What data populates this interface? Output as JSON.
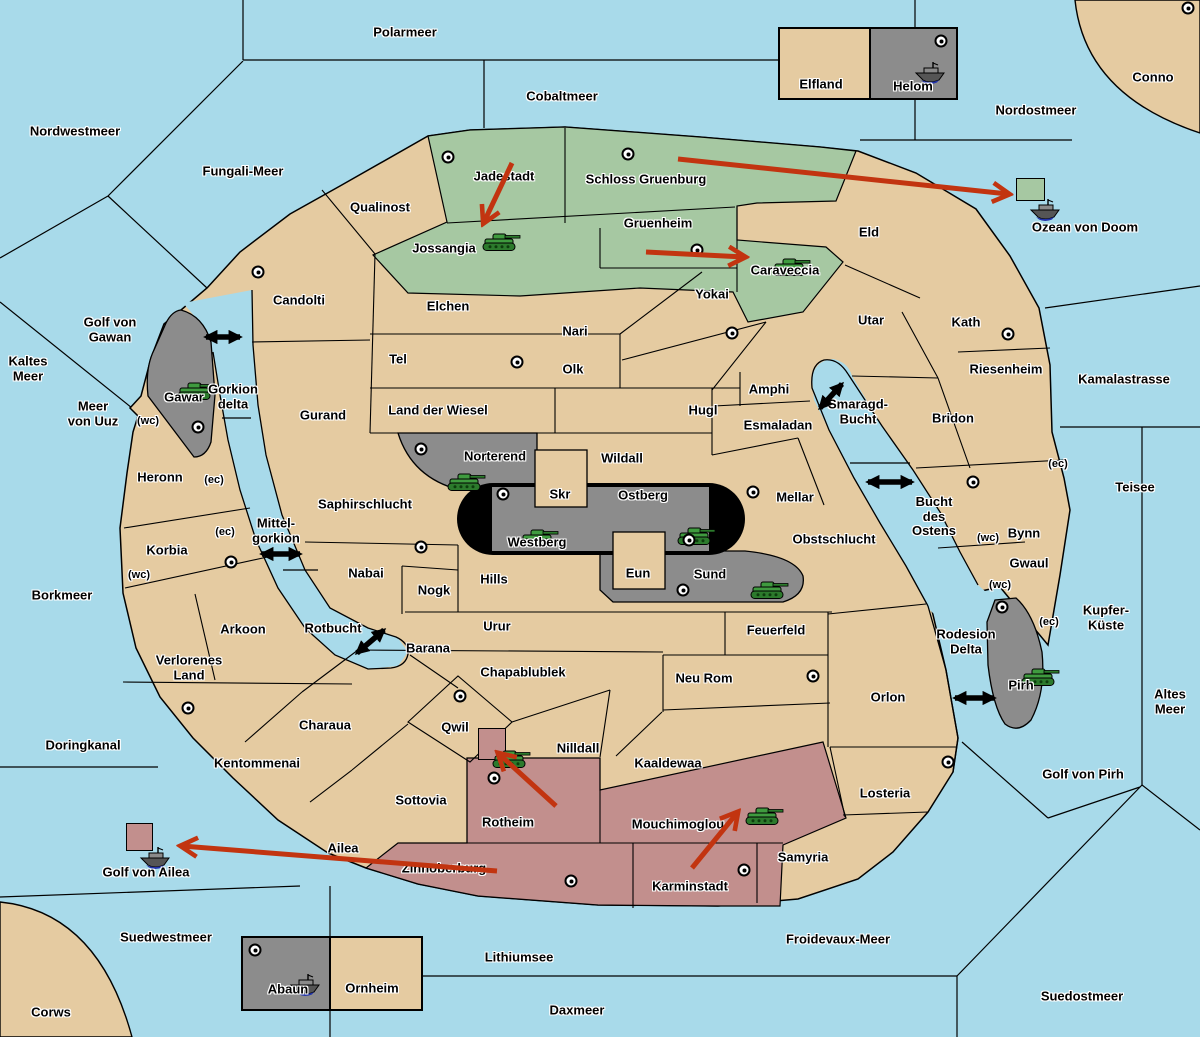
{
  "map": {
    "colors": {
      "water": "#a8daea",
      "land": "#e5cba1",
      "green_power": "#a6c8a2",
      "red_power": "#c28f8d",
      "gray_power": "#8c8c8c",
      "black_power": "#000000",
      "border": "#000000",
      "order_arrow": "#c23410",
      "strait_arrow": "#000000",
      "army_green": "#3f9b3f",
      "fleet_gray": "#5a5a5a"
    },
    "sea_labels": [
      {
        "n": "Polarmeer",
        "x": 405,
        "y": 33
      },
      {
        "n": "Cobaltmeer",
        "x": 562,
        "y": 97
      },
      {
        "n": "Nordwestmeer",
        "x": 75,
        "y": 132
      },
      {
        "n": "Fungali-Meer",
        "x": 243,
        "y": 172
      },
      {
        "n": "Nordostmeer",
        "x": 1036,
        "y": 111
      },
      {
        "n": "Ozean von Doom",
        "x": 1085,
        "y": 228
      },
      {
        "n": "Golf von Gawan",
        "x": 110,
        "y": 330,
        "l": [
          "Golf von",
          "Gawan"
        ]
      },
      {
        "n": "Kaltes Meer",
        "x": 28,
        "y": 369,
        "l": [
          "Kaltes",
          "Meer"
        ]
      },
      {
        "n": "Meer von Uuz",
        "x": 93,
        "y": 414,
        "l": [
          "Meer",
          "von Uuz"
        ]
      },
      {
        "n": "Gorkion delta",
        "x": 233,
        "y": 397,
        "l": [
          "Gorkion",
          "delta"
        ]
      },
      {
        "n": "Mittel-gorkion",
        "x": 276,
        "y": 531,
        "l": [
          "Mittel-",
          "gorkion"
        ]
      },
      {
        "n": "Rotbucht",
        "x": 333,
        "y": 629
      },
      {
        "n": "Smaragd-Bucht",
        "x": 858,
        "y": 412,
        "l": [
          "Smaragd-",
          "Bucht"
        ]
      },
      {
        "n": "Bucht des Ostens",
        "x": 934,
        "y": 517,
        "l": [
          "Bucht",
          "des",
          "Ostens"
        ]
      },
      {
        "n": "Rodesion Delta",
        "x": 966,
        "y": 642,
        "l": [
          "Rodesion",
          "Delta"
        ]
      },
      {
        "n": "Kamalastrasse",
        "x": 1124,
        "y": 380
      },
      {
        "n": "Teisee",
        "x": 1135,
        "y": 488
      },
      {
        "n": "Borkmeer",
        "x": 62,
        "y": 596
      },
      {
        "n": "Kupfer-Küste",
        "x": 1106,
        "y": 618,
        "l": [
          "Kupfer-",
          "Küste"
        ]
      },
      {
        "n": "Altes Meer",
        "x": 1170,
        "y": 702,
        "l": [
          "Altes",
          "Meer"
        ]
      },
      {
        "n": "Golf von Pirh",
        "x": 1083,
        "y": 775
      },
      {
        "n": "Doringkanal",
        "x": 83,
        "y": 746
      },
      {
        "n": "Golf von Ailea",
        "x": 146,
        "y": 873
      },
      {
        "n": "Suedwestmeer",
        "x": 166,
        "y": 938
      },
      {
        "n": "Lithiumsee",
        "x": 519,
        "y": 958
      },
      {
        "n": "Froidevaux-Meer",
        "x": 838,
        "y": 940
      },
      {
        "n": "Daxmeer",
        "x": 577,
        "y": 1011
      },
      {
        "n": "Suedostmeer",
        "x": 1082,
        "y": 997
      }
    ],
    "territory_labels": [
      {
        "n": "Conno",
        "x": 1153,
        "y": 78,
        "o": "neutral"
      },
      {
        "n": "Elfland",
        "x": 821,
        "y": 85,
        "o": "neutral"
      },
      {
        "n": "Helom",
        "x": 913,
        "y": 87,
        "o": "gray"
      },
      {
        "n": "Qualinost",
        "x": 380,
        "y": 208,
        "o": "neutral"
      },
      {
        "n": "Jadestadt",
        "x": 504,
        "y": 177,
        "o": "green"
      },
      {
        "n": "Schloss Gruenburg",
        "x": 646,
        "y": 180,
        "o": "green"
      },
      {
        "n": "Jossangia",
        "x": 444,
        "y": 249,
        "o": "green"
      },
      {
        "n": "Gruenheim",
        "x": 658,
        "y": 224,
        "o": "green"
      },
      {
        "n": "Caraveccia",
        "x": 785,
        "y": 271,
        "o": "green"
      },
      {
        "n": "Yokai",
        "x": 712,
        "y": 295,
        "o": "neutral"
      },
      {
        "n": "Eld",
        "x": 869,
        "y": 233,
        "o": "neutral"
      },
      {
        "n": "Utar",
        "x": 871,
        "y": 321,
        "o": "neutral"
      },
      {
        "n": "Kath",
        "x": 966,
        "y": 323,
        "o": "neutral"
      },
      {
        "n": "Candolti",
        "x": 299,
        "y": 301,
        "o": "neutral"
      },
      {
        "n": "Elchen",
        "x": 448,
        "y": 307,
        "o": "neutral"
      },
      {
        "n": "Nari",
        "x": 575,
        "y": 332,
        "o": "neutral"
      },
      {
        "n": "Tel",
        "x": 398,
        "y": 360,
        "o": "neutral"
      },
      {
        "n": "Olk",
        "x": 573,
        "y": 370,
        "o": "neutral"
      },
      {
        "n": "Gurand",
        "x": 323,
        "y": 416,
        "o": "neutral"
      },
      {
        "n": "Land der Wiesel",
        "x": 438,
        "y": 411,
        "o": "neutral"
      },
      {
        "n": "Hugl",
        "x": 703,
        "y": 411,
        "o": "neutral"
      },
      {
        "n": "Amphi",
        "x": 769,
        "y": 390,
        "o": "neutral"
      },
      {
        "n": "Esmaladan",
        "x": 778,
        "y": 426,
        "o": "neutral"
      },
      {
        "n": "Riesenheim",
        "x": 1006,
        "y": 370,
        "o": "neutral"
      },
      {
        "n": "Bridon",
        "x": 953,
        "y": 419,
        "o": "neutral"
      },
      {
        "n": "Gawar",
        "x": 184,
        "y": 398,
        "o": "gray"
      },
      {
        "n": "Heronn",
        "x": 160,
        "y": 478,
        "o": "neutral"
      },
      {
        "n": "Korbia",
        "x": 167,
        "y": 551,
        "o": "neutral"
      },
      {
        "n": "Norterend",
        "x": 495,
        "y": 457,
        "o": "gray"
      },
      {
        "n": "Wildall",
        "x": 622,
        "y": 459,
        "o": "neutral"
      },
      {
        "n": "Skr",
        "x": 560,
        "y": 495,
        "o": "neutral"
      },
      {
        "n": "Ostberg",
        "x": 643,
        "y": 496,
        "o": "gray"
      },
      {
        "n": "Westberg",
        "x": 537,
        "y": 543,
        "o": "gray"
      },
      {
        "n": "Mellar",
        "x": 795,
        "y": 498,
        "o": "neutral"
      },
      {
        "n": "Saphirschlucht",
        "x": 365,
        "y": 505,
        "o": "neutral"
      },
      {
        "n": "Obstschlucht",
        "x": 834,
        "y": 540,
        "o": "neutral"
      },
      {
        "n": "Eun",
        "x": 638,
        "y": 574,
        "o": "neutral"
      },
      {
        "n": "Sund",
        "x": 710,
        "y": 575,
        "o": "gray"
      },
      {
        "n": "Hills",
        "x": 494,
        "y": 580,
        "o": "neutral"
      },
      {
        "n": "Nabai",
        "x": 366,
        "y": 574,
        "o": "neutral"
      },
      {
        "n": "Nogk",
        "x": 434,
        "y": 591,
        "o": "neutral"
      },
      {
        "n": "Bynn",
        "x": 1024,
        "y": 534,
        "o": "neutral"
      },
      {
        "n": "Gwaul",
        "x": 1029,
        "y": 564,
        "o": "neutral"
      },
      {
        "n": "Pirh",
        "x": 1021,
        "y": 686,
        "o": "gray"
      },
      {
        "n": "Urur",
        "x": 497,
        "y": 627,
        "o": "neutral"
      },
      {
        "n": "Feuerfeld",
        "x": 776,
        "y": 631,
        "o": "neutral"
      },
      {
        "n": "Barana",
        "x": 428,
        "y": 649,
        "o": "neutral"
      },
      {
        "n": "Arkoon",
        "x": 243,
        "y": 630,
        "o": "neutral"
      },
      {
        "n": "Verlorenes Land",
        "x": 189,
        "y": 668,
        "o": "neutral",
        "l": [
          "Verlorenes",
          "Land"
        ]
      },
      {
        "n": "Chapablublek",
        "x": 523,
        "y": 673,
        "o": "neutral"
      },
      {
        "n": "Neu Rom",
        "x": 704,
        "y": 679,
        "o": "neutral"
      },
      {
        "n": "Orlon",
        "x": 888,
        "y": 698,
        "o": "neutral"
      },
      {
        "n": "Charaua",
        "x": 325,
        "y": 726,
        "o": "neutral"
      },
      {
        "n": "Qwil",
        "x": 455,
        "y": 728,
        "o": "neutral"
      },
      {
        "n": "Nilldall",
        "x": 578,
        "y": 749,
        "o": "neutral"
      },
      {
        "n": "Kaaldewaa",
        "x": 668,
        "y": 764,
        "o": "neutral"
      },
      {
        "n": "Kentommenai",
        "x": 257,
        "y": 764,
        "o": "neutral"
      },
      {
        "n": "Sottovia",
        "x": 421,
        "y": 801,
        "o": "neutral"
      },
      {
        "n": "Rotheim",
        "x": 508,
        "y": 823,
        "o": "red"
      },
      {
        "n": "Mouchimoglou",
        "x": 678,
        "y": 825,
        "o": "red"
      },
      {
        "n": "Losteria",
        "x": 885,
        "y": 794,
        "o": "neutral"
      },
      {
        "n": "Ailea",
        "x": 343,
        "y": 849,
        "o": "neutral"
      },
      {
        "n": "Samyria",
        "x": 803,
        "y": 858,
        "o": "neutral"
      },
      {
        "n": "Zinnoberburg",
        "x": 444,
        "y": 869,
        "o": "red"
      },
      {
        "n": "Karminstadt",
        "x": 690,
        "y": 887,
        "o": "red"
      },
      {
        "n": "Abaun",
        "x": 288,
        "y": 990,
        "o": "gray"
      },
      {
        "n": "Ornheim",
        "x": 372,
        "y": 989,
        "o": "neutral"
      },
      {
        "n": "Corws",
        "x": 51,
        "y": 1013,
        "o": "neutral"
      }
    ],
    "coast_tags": [
      {
        "t": "(wc)",
        "x": 148,
        "y": 421
      },
      {
        "t": "(ec)",
        "x": 214,
        "y": 480
      },
      {
        "t": "(ec)",
        "x": 225,
        "y": 532
      },
      {
        "t": "(wc)",
        "x": 139,
        "y": 575
      },
      {
        "t": "(ec)",
        "x": 1058,
        "y": 464
      },
      {
        "t": "(wc)",
        "x": 988,
        "y": 538
      },
      {
        "t": "(wc)",
        "x": 1000,
        "y": 585
      },
      {
        "t": "(ec)",
        "x": 1049,
        "y": 622
      }
    ],
    "supply_centers": [
      [
        448,
        157
      ],
      [
        628,
        154
      ],
      [
        697,
        250
      ],
      [
        732,
        333
      ],
      [
        941,
        41
      ],
      [
        1188,
        8
      ],
      [
        258,
        272
      ],
      [
        517,
        362
      ],
      [
        198,
        427
      ],
      [
        1008,
        334
      ],
      [
        753,
        492
      ],
      [
        973,
        482
      ],
      [
        1002,
        607
      ],
      [
        421,
        449
      ],
      [
        503,
        494
      ],
      [
        689,
        540
      ],
      [
        683,
        590
      ],
      [
        421,
        547
      ],
      [
        231,
        562
      ],
      [
        188,
        708
      ],
      [
        813,
        676
      ],
      [
        948,
        762
      ],
      [
        460,
        696
      ],
      [
        494,
        778
      ],
      [
        571,
        881
      ],
      [
        744,
        870
      ],
      [
        255,
        950
      ]
    ],
    "units": [
      {
        "t": "army",
        "x": 480,
        "y": 230
      },
      {
        "t": "army",
        "x": 770,
        "y": 255
      },
      {
        "t": "army",
        "x": 175,
        "y": 379
      },
      {
        "t": "army",
        "x": 445,
        "y": 470
      },
      {
        "t": "army",
        "x": 518,
        "y": 526
      },
      {
        "t": "army",
        "x": 675,
        "y": 524
      },
      {
        "t": "army",
        "x": 748,
        "y": 578
      },
      {
        "t": "army",
        "x": 1019,
        "y": 665
      },
      {
        "t": "army",
        "x": 490,
        "y": 747,
        "box": [
          478,
          728,
          26,
          30
        ],
        "boxcolor": "red_power"
      },
      {
        "t": "army",
        "x": 743,
        "y": 804
      },
      {
        "t": "fleet",
        "x": 913,
        "y": 60
      },
      {
        "t": "fleet",
        "x": 1028,
        "y": 197,
        "box": [
          1016,
          178,
          27,
          21
        ],
        "boxcolor": "green_power"
      },
      {
        "t": "fleet",
        "x": 138,
        "y": 845,
        "box": [
          126,
          823,
          25,
          26
        ],
        "boxcolor": "red_power"
      },
      {
        "t": "fleet",
        "x": 288,
        "y": 972
      }
    ],
    "orders": [
      [
        512,
        163,
        484,
        222
      ],
      [
        646,
        252,
        744,
        257
      ],
      [
        678,
        159,
        1008,
        194
      ],
      [
        556,
        806,
        499,
        754
      ],
      [
        692,
        868,
        737,
        813
      ],
      [
        497,
        871,
        182,
        846
      ]
    ],
    "straits": [
      [
        206,
        337,
        240,
        337
      ],
      [
        262,
        554,
        300,
        554
      ],
      [
        357,
        653,
        384,
        630
      ],
      [
        820,
        408,
        842,
        384
      ],
      [
        868,
        482,
        912,
        482
      ],
      [
        955,
        698,
        994,
        698
      ]
    ]
  }
}
